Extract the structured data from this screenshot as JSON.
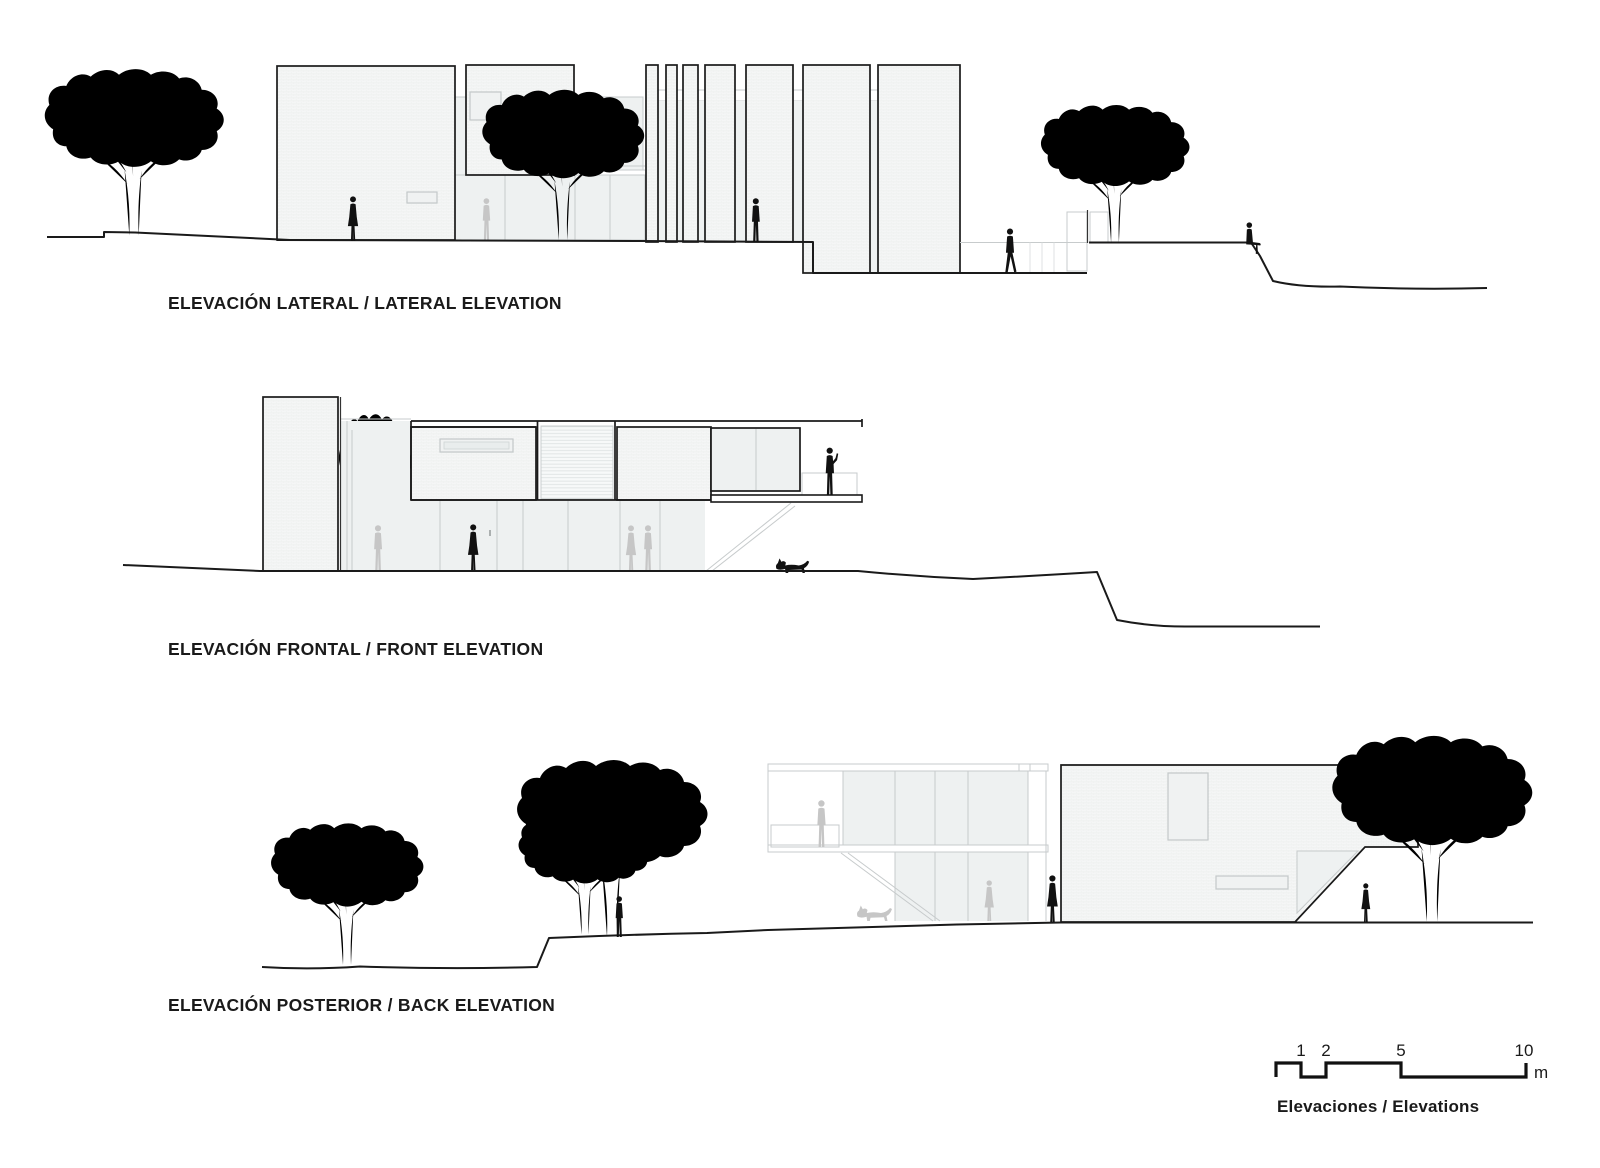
{
  "document": {
    "type": "architectural-elevations-sheet"
  },
  "palette": {
    "paper": "#ffffff",
    "line": "#1a1a1a",
    "light": "#c7cbcc",
    "faint": "#dcdfe0",
    "ghost": "#c6c6c6",
    "sil": "#111111",
    "glass": "#eef1f1",
    "brick": "#f5f6f6"
  },
  "elevations": [
    {
      "id": "lateral",
      "title": "ELEVACIÓN LATERAL / LATERAL ELEVATION"
    },
    {
      "id": "frontal",
      "title": "ELEVACIÓN FRONTAL / FRONT ELEVATION"
    },
    {
      "id": "posterior",
      "title": "ELEVACIÓN POSTERIOR / BACK ELEVATION"
    }
  ],
  "scale_bar": {
    "tick_labels": [
      "1",
      "2",
      "5",
      "10"
    ],
    "unit_label": "m",
    "caption": "Elevaciones / Elevations"
  }
}
